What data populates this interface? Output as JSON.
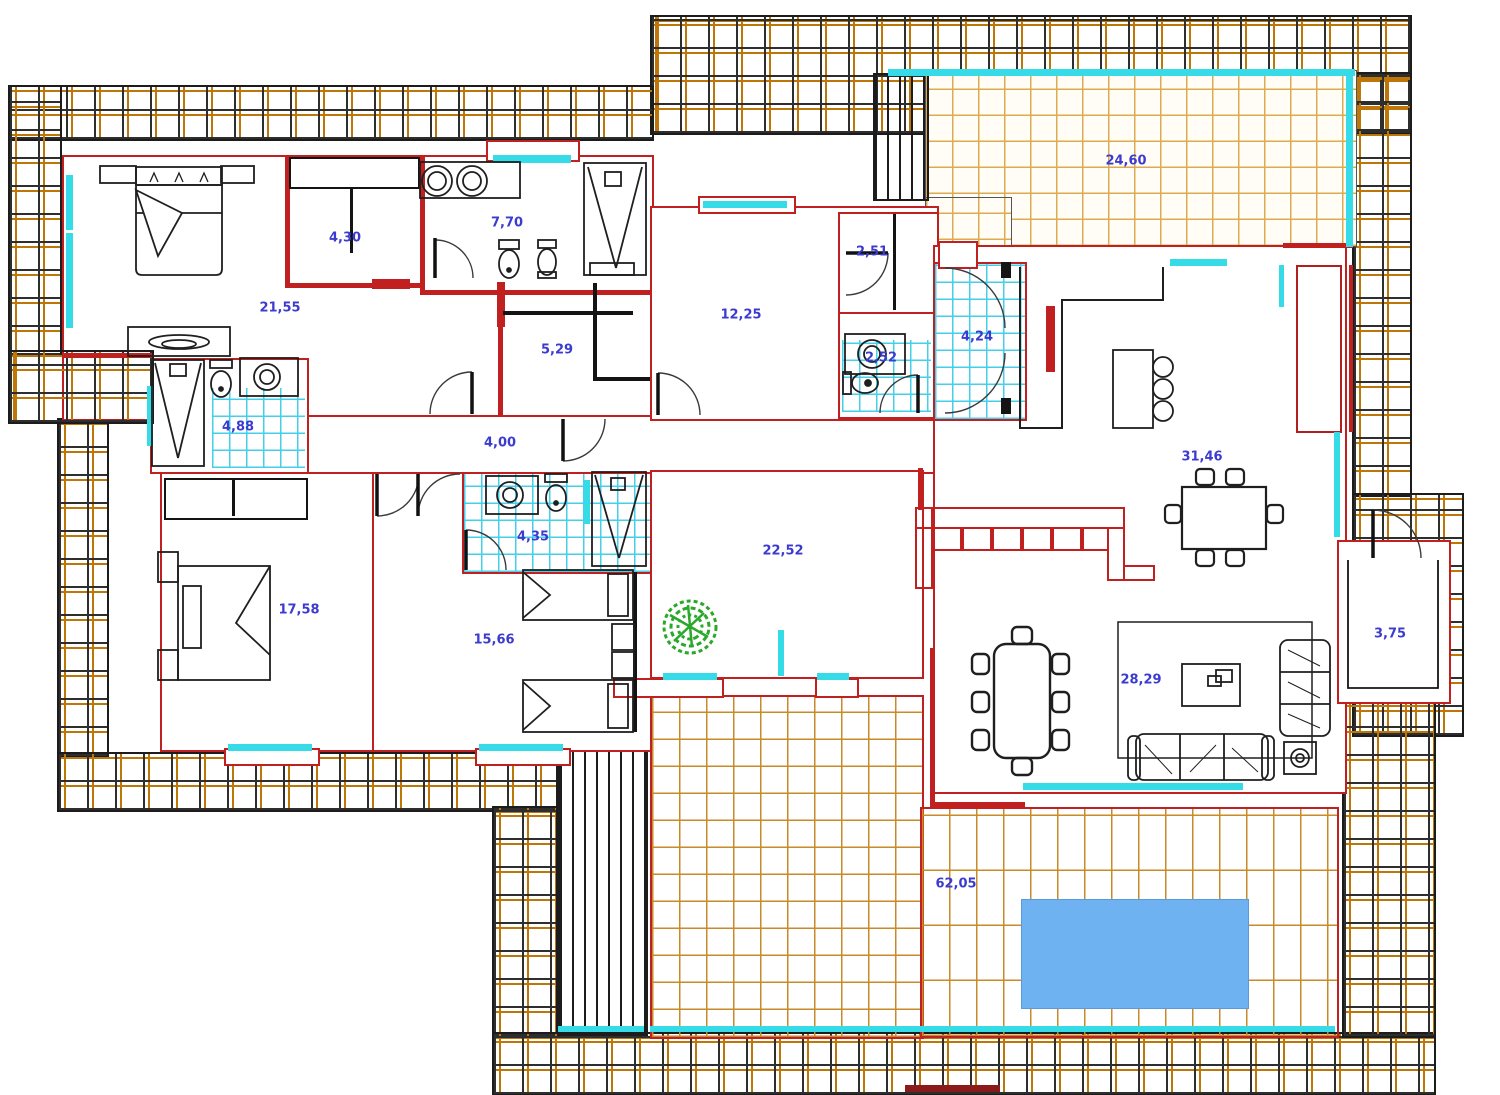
{
  "labels": [
    {
      "name": "master-bedroom",
      "value": "21,55"
    },
    {
      "name": "closet-1",
      "value": "4,30"
    },
    {
      "name": "bathroom-1",
      "value": "7,70"
    },
    {
      "name": "storage",
      "value": "5,29"
    },
    {
      "name": "bathroom-2",
      "value": "4,88"
    },
    {
      "name": "corridor",
      "value": "4,00"
    },
    {
      "name": "room-12",
      "value": "12,25"
    },
    {
      "name": "closet-2",
      "value": "2,51"
    },
    {
      "name": "wc",
      "value": "2,52"
    },
    {
      "name": "hall",
      "value": "4,24"
    },
    {
      "name": "terrace-top",
      "value": "24,60"
    },
    {
      "name": "kitchen-dining",
      "value": "31,46"
    },
    {
      "name": "bedroom-2",
      "value": "17,58"
    },
    {
      "name": "bedroom-3",
      "value": "15,66"
    },
    {
      "name": "bathroom-3",
      "value": "4,35"
    },
    {
      "name": "living-room",
      "value": "22,52"
    },
    {
      "name": "lounge",
      "value": "28,29"
    },
    {
      "name": "entry",
      "value": "3,75"
    },
    {
      "name": "pool-terrace",
      "value": "62,05"
    }
  ],
  "colors": {
    "wall": "#c12020",
    "window": "#35dce8",
    "tile": "#bd7607",
    "tile_light": "#dcaa50",
    "label": "#3b3bd0",
    "pool": "#6fb2f2",
    "plant": "#2aa82a"
  }
}
